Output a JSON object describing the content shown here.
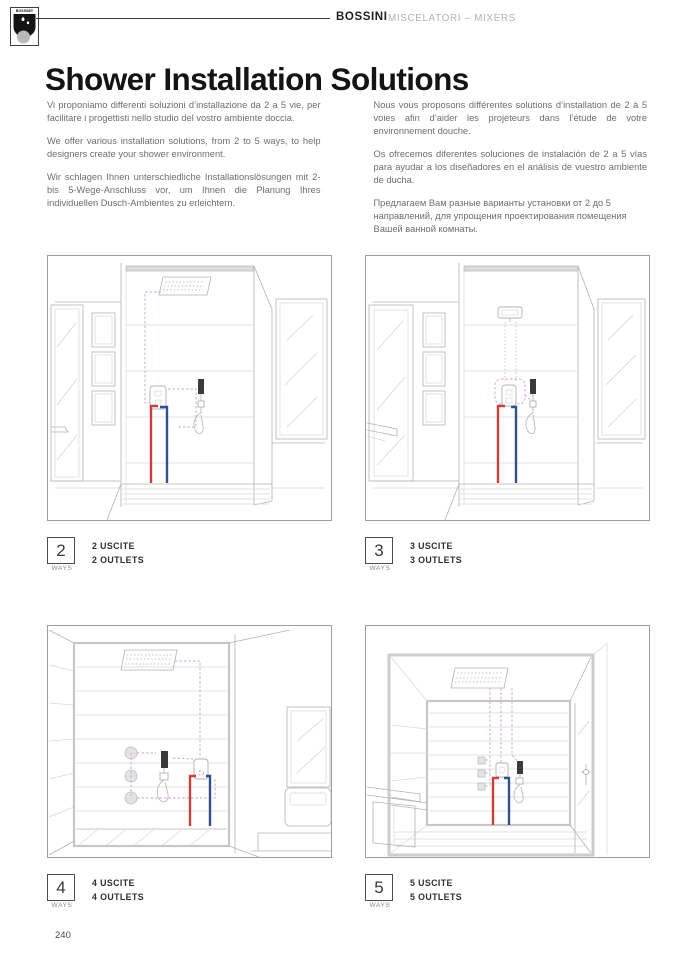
{
  "header": {
    "logo_text": "BOSSINI®",
    "brand": "BOSSINI",
    "category": "MISCELATORI – MIXERS"
  },
  "title": "Shower Installation Solutions",
  "intro": {
    "left": [
      "Vi proponiamo differenti soluzioni d’installazione da 2 a 5 vie, per facilitare i progettisti nello studio del vostro ambiente doccia.",
      "We offer various installation solutions, from 2 to 5 ways, to help designers create your shower environment.",
      "Wir schlagen Ihnen unterschiedliche Installationslösungen mit 2- bis 5-Wege-Anschluss vor, um Ihnen die Planung Ihres individuellen Dusch-Ambientes zu erleichtern."
    ],
    "right": [
      "Nous vous proposons différentes solutions d’installation de 2 à 5 voies afin d’aider les projeteurs dans l’étude de votre environnement douche.",
      "Os ofrecemos diferentes soluciones de instalación de 2 a 5 vías para ayudar a los diseñadores en el análisis de vuestro ambiente de ducha.",
      "Предлагаем Вам разные варианты установки от 2 до 5 направлений, для упрощения проектирования помещения Вашей ванной комнаты."
    ]
  },
  "figures": [
    {
      "number": "2",
      "ways_label": "WAYS",
      "caption_line1": "2 USCITE",
      "caption_line2": "2 OUTLETS"
    },
    {
      "number": "3",
      "ways_label": "WAYS",
      "caption_line1": "3 USCITE",
      "caption_line2": "3 OUTLETS"
    },
    {
      "number": "4",
      "ways_label": "WAYS",
      "caption_line1": "4 USCITE",
      "caption_line2": "4 OUTLETS"
    },
    {
      "number": "5",
      "ways_label": "WAYS",
      "caption_line1": "5 USCITE",
      "caption_line2": "5 OUTLETS"
    }
  ],
  "footer": {
    "page_number": "240"
  },
  "colors": {
    "hot_pipe": "#c8403a",
    "cold_pipe": "#31508c",
    "route_dashed": "#c4a5cc"
  }
}
